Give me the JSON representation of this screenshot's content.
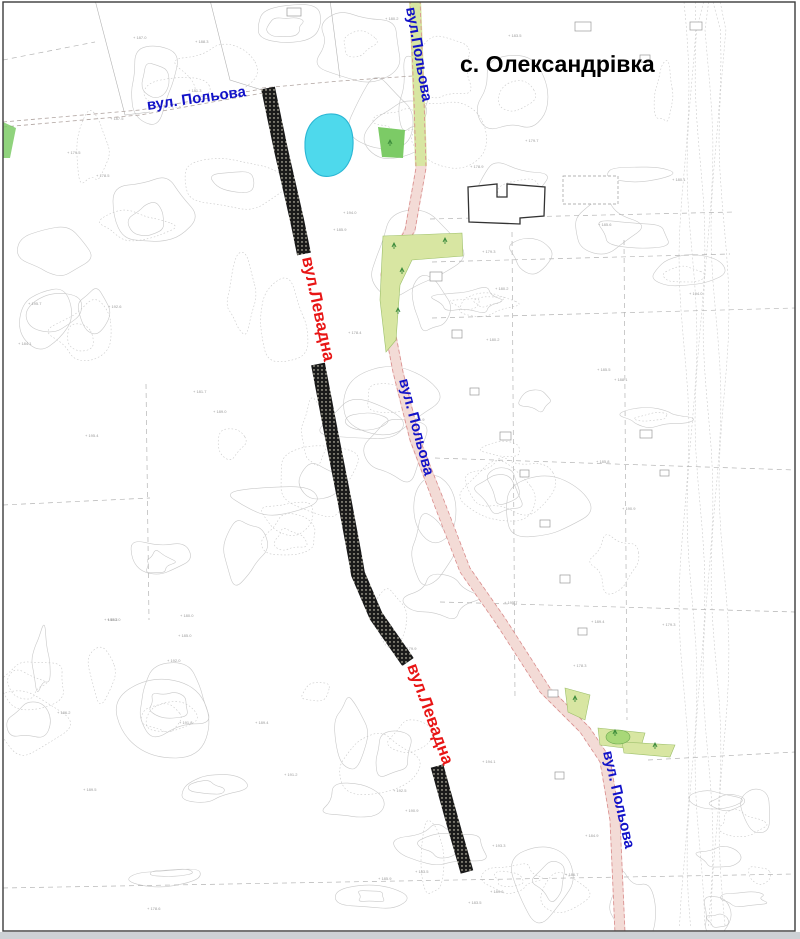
{
  "map": {
    "title": "с. Олександрівка",
    "labels": [
      {
        "id": "polova-top-left",
        "text": "вул. Польова",
        "color": "#1212c8"
      },
      {
        "id": "polova-top-center",
        "text": "вул.Польова",
        "color": "#1212c8"
      },
      {
        "id": "polova-middle",
        "text": "вул. Польова",
        "color": "#1212c8"
      },
      {
        "id": "polova-bottom-right",
        "text": "вул. Польова",
        "color": "#1212c8"
      },
      {
        "id": "levadna-upper",
        "text": "вул.Левадна",
        "color": "#e81515"
      },
      {
        "id": "levadna-lower",
        "text": "вул.Левадна",
        "color": "#e81515"
      }
    ],
    "colors": {
      "title": "#000000",
      "pond_fill": "#4ed9ec",
      "pond_stroke": "#2ab6d4",
      "vegetation_bright": "#7ccb66",
      "vegetation_light": "#d8e6a2",
      "road_existing_fill": "#f3dbd6",
      "road_existing_edge": "#d98c8c",
      "road_planned": "#1a1a1a",
      "contour": "#c9c9c9",
      "parcel_line": "#b4b4b4",
      "frame": "#3c3c3c"
    }
  }
}
